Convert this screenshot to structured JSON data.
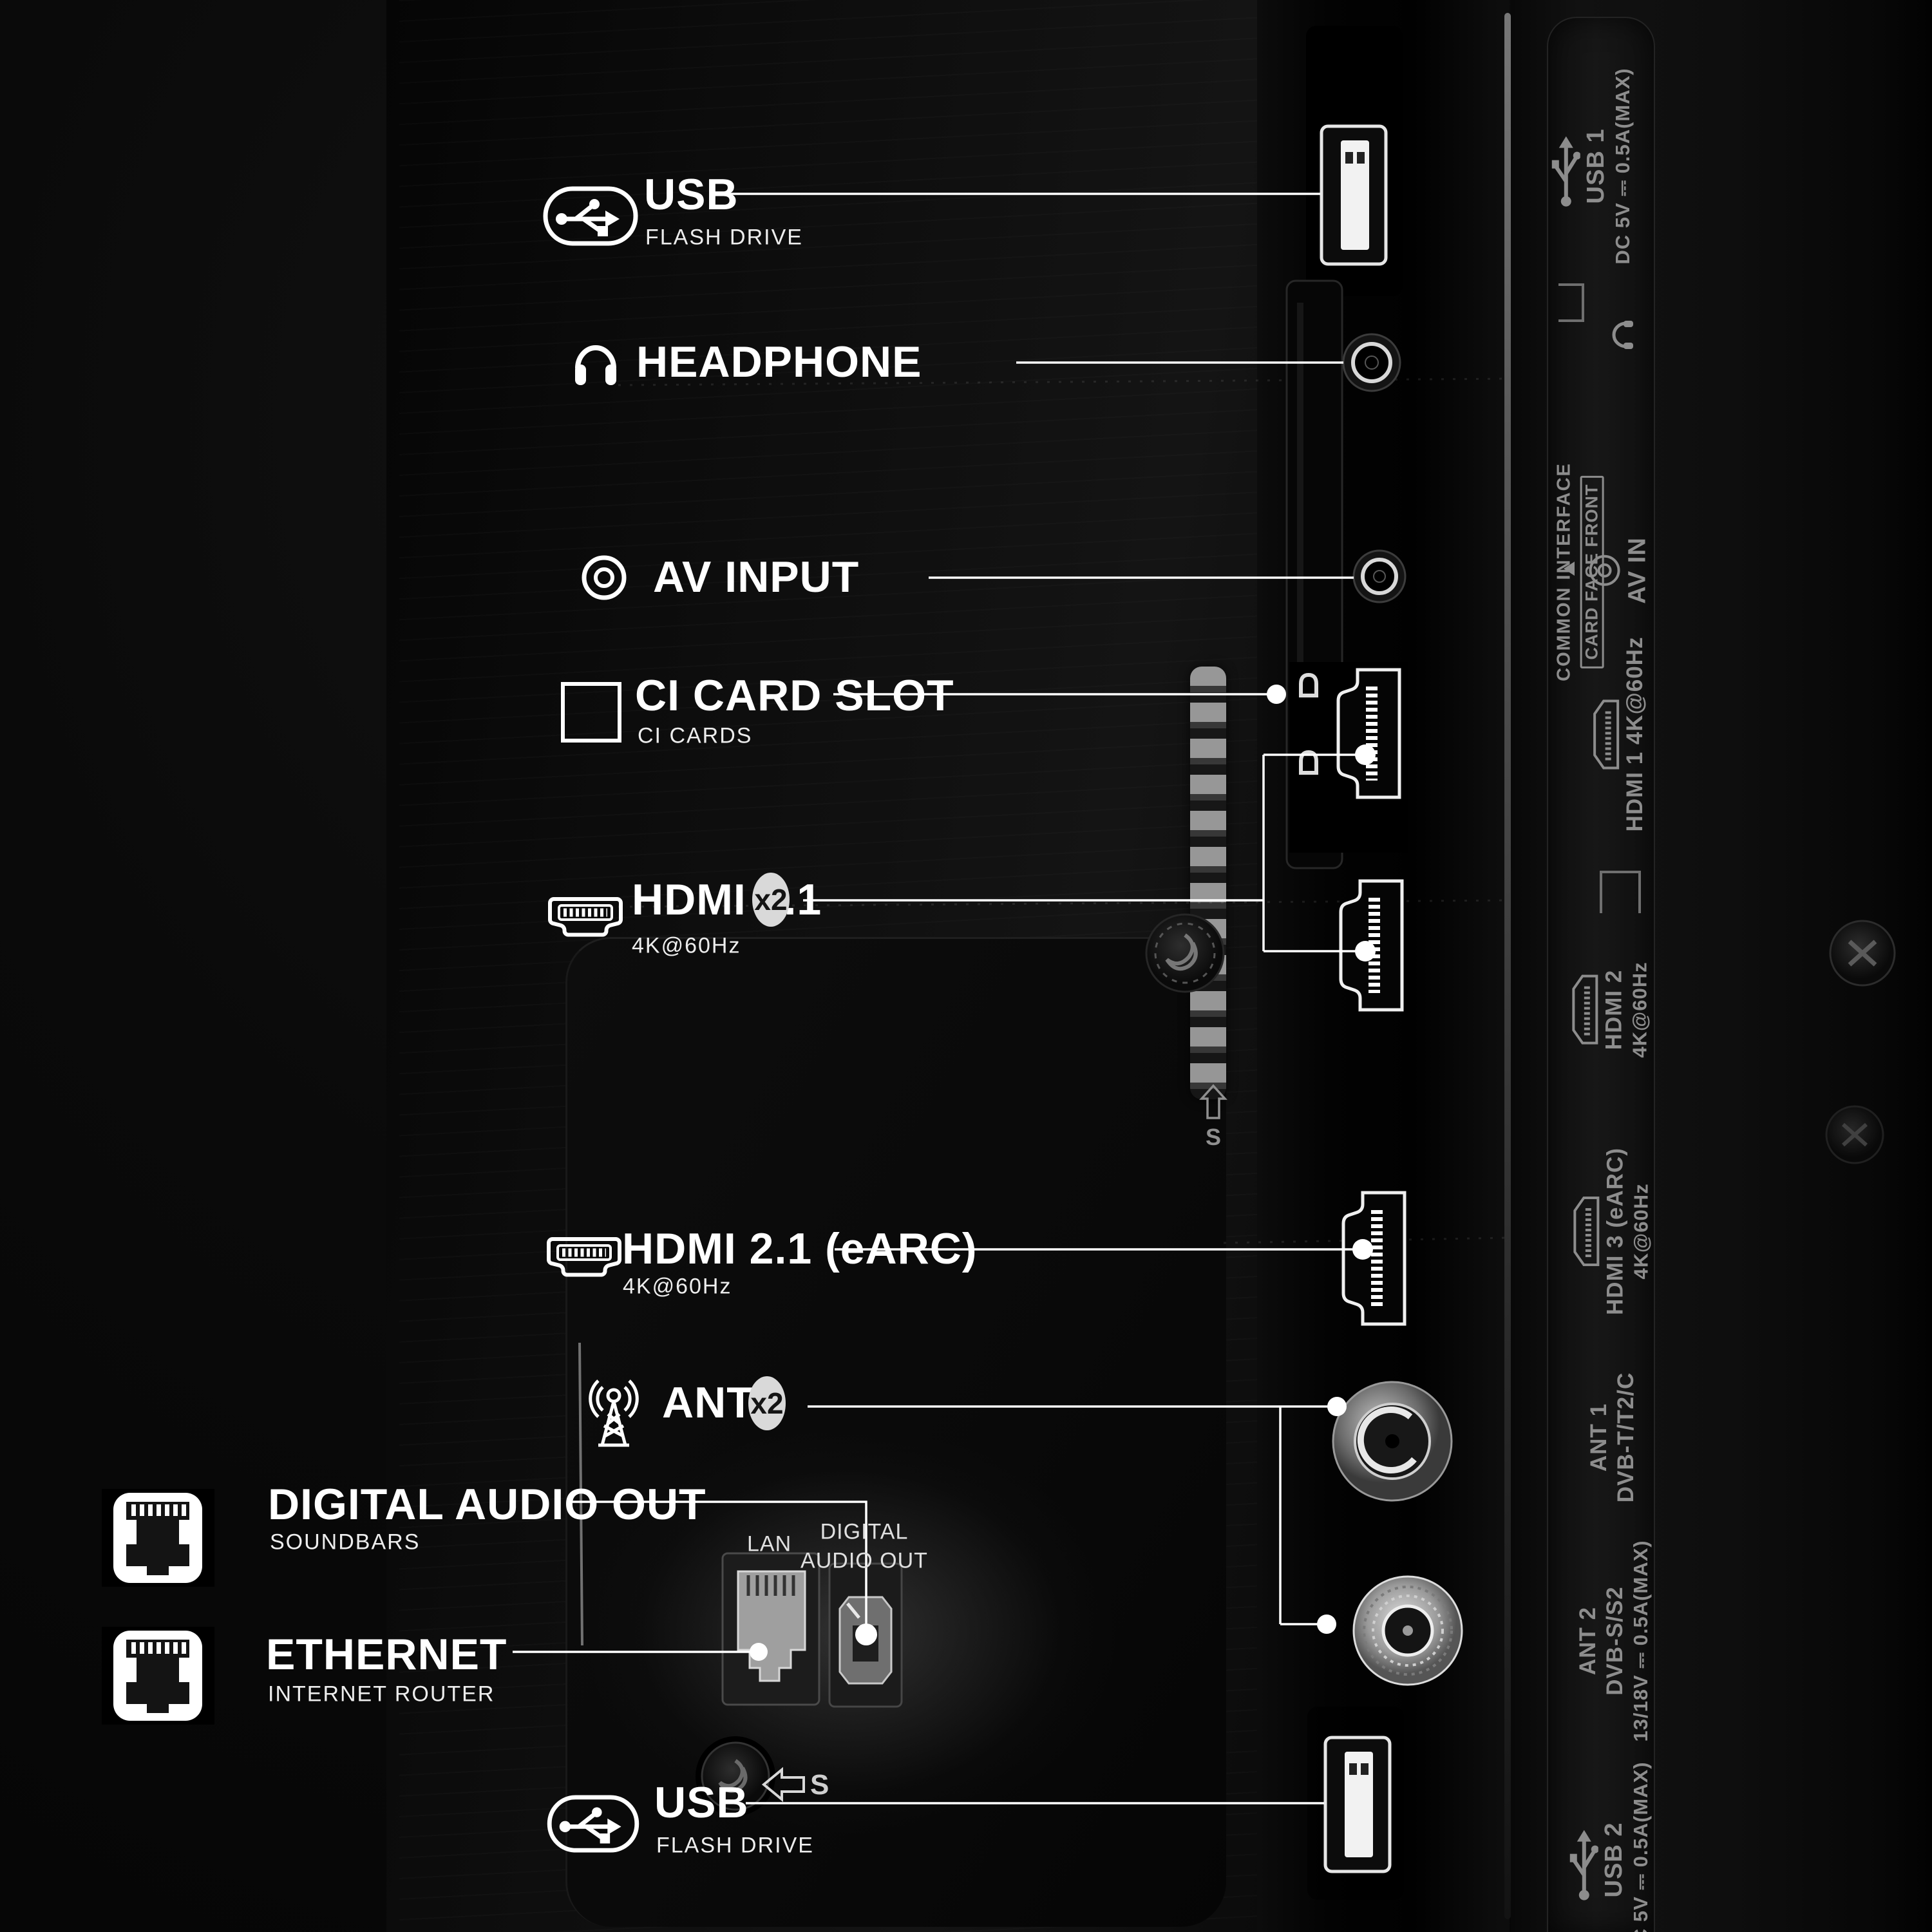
{
  "colors": {
    "background": "#060606",
    "leader_line": "#ffffff",
    "title_text": "#ffffff",
    "subtitle_text": "#ededed",
    "plate_text": "#8d8d8d",
    "panel_text": "#e0e0e0",
    "badge_bg": "#d9d9d9",
    "badge_text": "#141414"
  },
  "callouts": {
    "usb_top": {
      "title": "USB",
      "subtitle": "FLASH DRIVE",
      "icon": "usb-icon"
    },
    "headphone": {
      "title": "HEADPHONE",
      "icon": "headphone-icon"
    },
    "av_input": {
      "title": "AV INPUT",
      "icon": "av-target-icon"
    },
    "ci_card_slot": {
      "title": "CI CARD SLOT",
      "subtitle": "CI CARDS",
      "icon": "card-slot-icon"
    },
    "hdmi": {
      "title": "HDMI 2.1",
      "badge": "x2",
      "subtitle": "4K@60Hz",
      "icon": "hdmi-icon"
    },
    "hdmi_earc": {
      "title": "HDMI 2.1 (eARC)",
      "subtitle": "4K@60Hz",
      "icon": "hdmi-icon"
    },
    "ant": {
      "title": "ANT",
      "badge": "x2",
      "icon": "antenna-icon"
    },
    "digital_audio_out": {
      "title": "DIGITAL AUDIO OUT",
      "subtitle": "SOUNDBARS",
      "icon": "rj45-icon"
    },
    "ethernet": {
      "title": "ETHERNET",
      "subtitle": "INTERNET ROUTER",
      "icon": "rj45-icon"
    },
    "usb_bottom": {
      "title": "USB",
      "subtitle": "FLASH DRIVE",
      "icon": "usb-icon"
    }
  },
  "panel": {
    "lan": "LAN",
    "digital_line1": "DIGITAL",
    "digital_line2": "AUDIO OUT",
    "s_marker_bottom": "S",
    "s_marker_mid": "S"
  },
  "plate": {
    "usb1": {
      "line1": "USB 1",
      "line2": "DC 5V ⎓ 0.5A(MAX)"
    },
    "common_interface": {
      "line1": "COMMON INTERFACE",
      "line2": "CARD FACE FRONT"
    },
    "av_in": {
      "line1": "AV IN"
    },
    "hdmi1": {
      "line1": "HDMI 1 4K@60Hz"
    },
    "hdmi2": {
      "line1": "HDMI 2",
      "line2": "4K@60Hz"
    },
    "hdmi3": {
      "line1": "HDMI 3 (eARC)",
      "line2": "4K@60Hz"
    },
    "ant1": {
      "line1": "ANT 1",
      "line2": "DVB-T/T2/C"
    },
    "ant2": {
      "line1": "ANT 2",
      "line2": "DVB-S/S2",
      "line3": "13/18V ⎓ 0.5A(MAX)"
    },
    "usb2": {
      "line1": "USB 2",
      "line2": "DC 5V ⎓ 0.5A(MAX)"
    }
  }
}
